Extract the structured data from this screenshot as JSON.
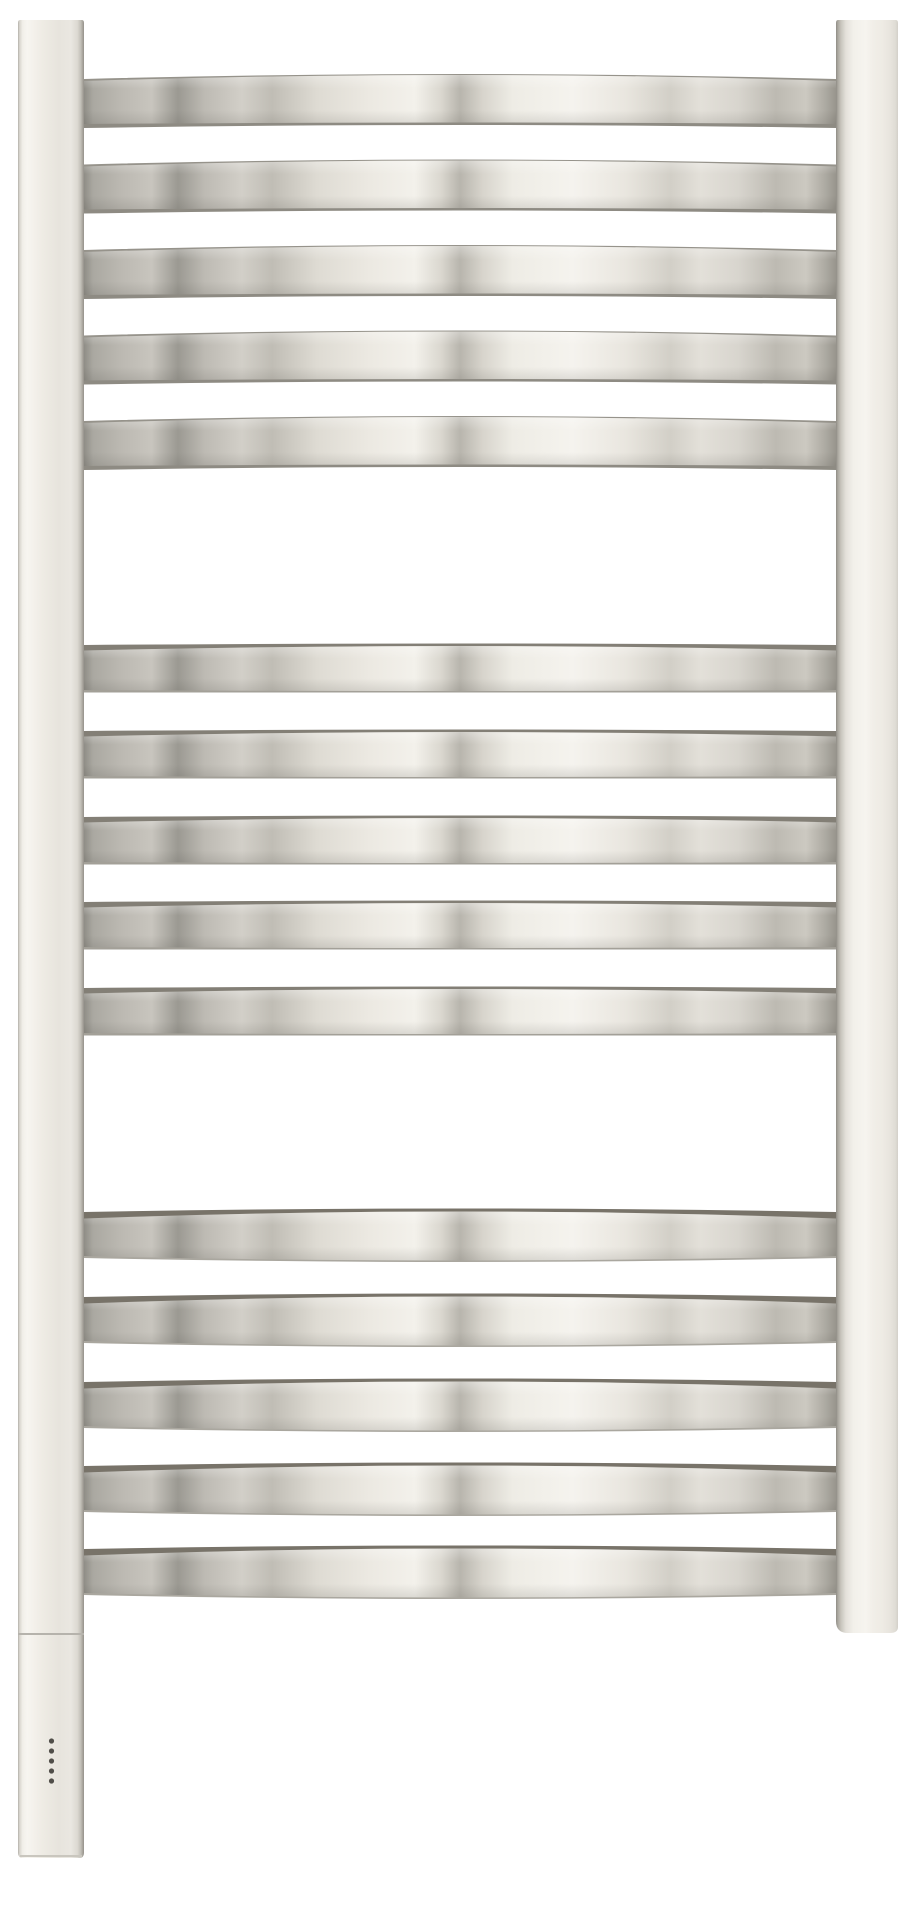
{
  "meta": {
    "description": "Product photo of a polished nickel curved ladder towel warmer (heated towel rail) on a white background",
    "background_color": "#ffffff"
  },
  "palette": {
    "chrome_bright": "#f5f3ee",
    "chrome_mid": "#d2cfc8",
    "chrome_dark_end": "#8f8d86",
    "bar_top_edge_dark": "#78746a",
    "frame_cream": "#eeebe4",
    "frame_edge_dark": "#94918a",
    "led_color": "#504e49",
    "seam_color": "#a9a69e"
  },
  "rail": {
    "bar_count": 15,
    "groups_of": 5,
    "bars": {
      "x": 84,
      "width": 752,
      "groups": [
        {
          "name": "top-group",
          "style": "below",
          "tops": [
            79,
            164.5,
            250,
            335.5,
            421
          ]
        },
        {
          "name": "middle-group",
          "style": "level",
          "tops": [
            645,
            731,
            817,
            902,
            988
          ]
        },
        {
          "name": "bottom-group",
          "style": "above",
          "tops": [
            1212,
            1297,
            1382,
            1466,
            1549
          ]
        }
      ],
      "styles": {
        "below": {
          "stripRise": 5,
          "stripEndH": 2.5,
          "stripMidH": 1.5,
          "stripColor": "#96938b",
          "faceEndH": 45,
          "faceMidBottom": 43.5,
          "botEndH": 4,
          "botMidH": 2.5,
          "botColor": "#8e8b83"
        },
        "level": {
          "stripRise": 1.5,
          "stripEndH": 6,
          "stripMidH": 3,
          "stripColor": "#837f76",
          "faceEndH": 45,
          "faceMidBottom": 46,
          "botEndH": 2.5,
          "botMidH": 1.5,
          "botColor": "#a3a098"
        },
        "above": {
          "stripRise": 3.5,
          "stripEndH": 7,
          "stripMidH": 3.5,
          "stripColor": "#787369",
          "faceEndH": 44,
          "faceMidBottom": 48.5,
          "botEndH": 2,
          "botMidH": 1.5,
          "botColor": "#aaa79f"
        }
      }
    },
    "left_post": {
      "x": 18,
      "y": 20,
      "width": 66,
      "height": 1613
    },
    "right_post": {
      "x": 836,
      "y": 20,
      "width": 62,
      "height": 1613
    },
    "control_box": {
      "x": 18,
      "y": 1635,
      "width": 66,
      "height": 223,
      "seam_y": 1633
    },
    "leds": {
      "count": 5,
      "cx": 51.5,
      "first_cy": 1741,
      "spacing": 10,
      "radius": 2.6
    }
  }
}
